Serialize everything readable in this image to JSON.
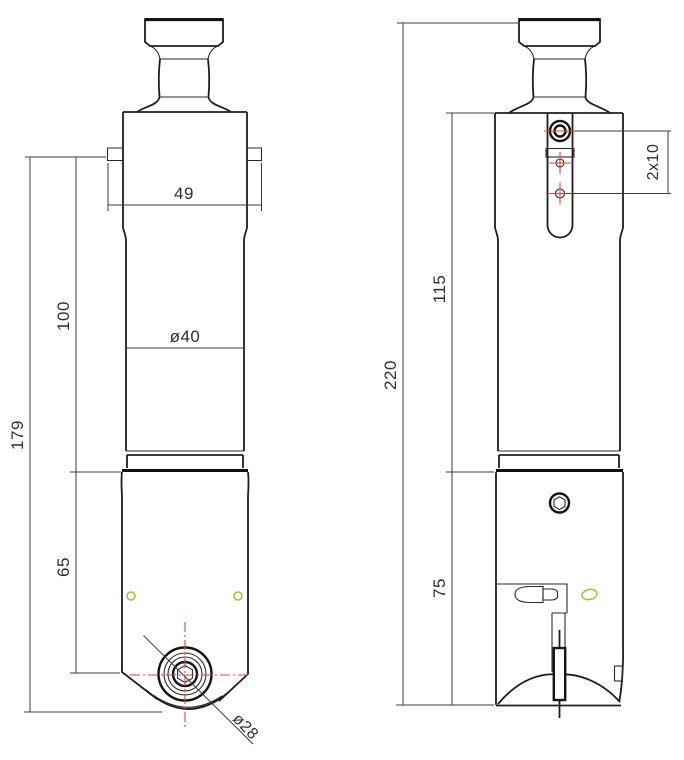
{
  "dimensions": {
    "flange_width": "49",
    "shank_diameter": "ø40",
    "shank_length": "100",
    "front_overall_height": "179",
    "head_height": "65",
    "cutting_diameter": "ø28",
    "side_upper_length": "115",
    "side_overall_length": "220",
    "side_head_length": "75",
    "hole_spacing": "2x10"
  },
  "colors": {
    "outline": "#1e1e1e",
    "dimension_line": "#3c3c3c",
    "centerline_red": "#dd4538",
    "feature_yellow": "#b2b43c",
    "feature_yellow_fill": "#fdfdec"
  }
}
